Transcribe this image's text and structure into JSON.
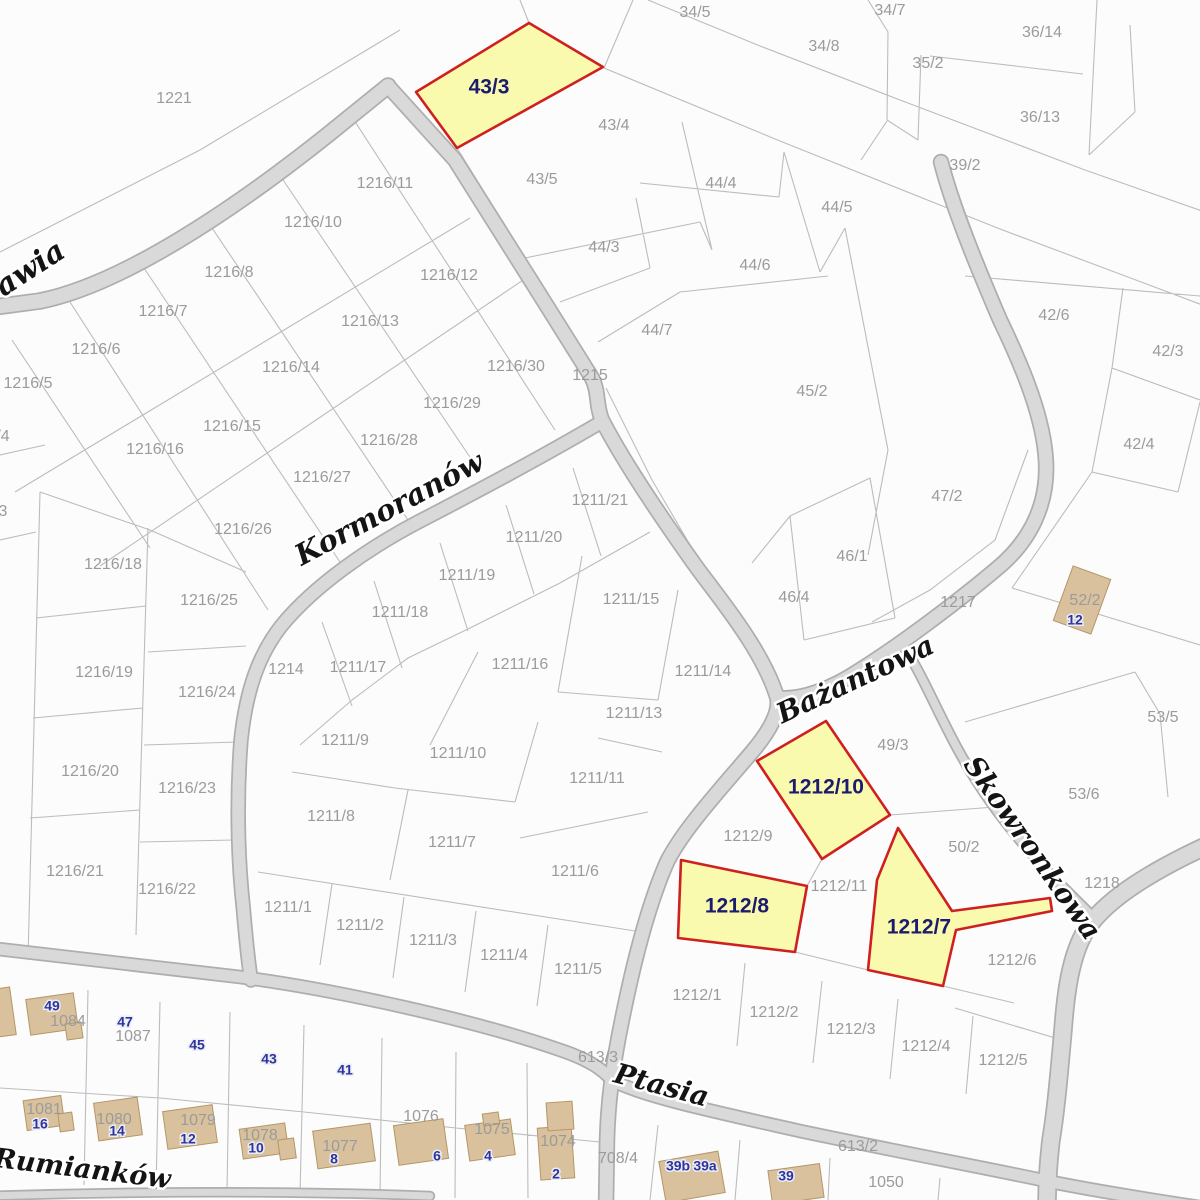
{
  "canvas": {
    "width": 1200,
    "height": 1200
  },
  "palette": {
    "bg": "#fcfcfc",
    "parcel_line": "#bcbcbc",
    "road_fill": "#d9d9d9",
    "road_edge": "#aeaeae",
    "highlight_fill": "#fafaaf",
    "highlight_border": "#cf2020",
    "building_fill": "#d8c19c",
    "building_edge": "#b49668",
    "label_gray": "#9b9b9b",
    "label_navy": "#1c1c6e",
    "badge_navy": "#32329b"
  },
  "streets": [
    {
      "name": "Żurawia",
      "x": 6,
      "y": 286,
      "rot": -33,
      "size": 30
    },
    {
      "name": "Kormoranów",
      "x": 390,
      "y": 510,
      "rot": -28,
      "size": 29
    },
    {
      "name": "Bażantowa",
      "x": 856,
      "y": 681,
      "rot": -25,
      "size": 28
    },
    {
      "name": "Skowronkowa",
      "x": 1031,
      "y": 849,
      "rot": 55,
      "size": 28
    },
    {
      "name": "Ptasia",
      "x": 661,
      "y": 1087,
      "rot": 15,
      "size": 28
    },
    {
      "name": "Rumianków",
      "x": 82,
      "y": 1170,
      "rot": 7,
      "size": 27
    }
  ],
  "highlight_parcels": [
    {
      "id": "43/3",
      "points": "416,92 529,23 603,67 457,148",
      "label": {
        "text": "43/3",
        "x": 489,
        "y": 88
      }
    },
    {
      "id": "1212/10",
      "points": "757,761 826,721 890,815 822,859",
      "label": {
        "text": "1212/10",
        "x": 826,
        "y": 788
      }
    },
    {
      "id": "1212/8",
      "points": "681,860 807,886 795,952 678,938",
      "label": {
        "text": "1212/8",
        "x": 737,
        "y": 907
      }
    },
    {
      "id": "1212/7",
      "points": "898,828 952,911 1050,898 1052,911 956,930 943,986 868,970 877,880",
      "label": {
        "text": "1212/7",
        "x": 919,
        "y": 928
      }
    }
  ],
  "parcel_labels": [
    {
      "text": "34/5",
      "x": 695,
      "y": 13
    },
    {
      "text": "34/7",
      "x": 890,
      "y": 11
    },
    {
      "text": "34/8",
      "x": 824,
      "y": 47
    },
    {
      "text": "35/2",
      "x": 928,
      "y": 64
    },
    {
      "text": "36/14",
      "x": 1042,
      "y": 33
    },
    {
      "text": "36/13",
      "x": 1040,
      "y": 118
    },
    {
      "text": "39/2",
      "x": 965,
      "y": 166
    },
    {
      "text": "1221",
      "x": 174,
      "y": 99
    },
    {
      "text": "43/4",
      "x": 614,
      "y": 126
    },
    {
      "text": "43/5",
      "x": 542,
      "y": 180
    },
    {
      "text": "44/4",
      "x": 721,
      "y": 184
    },
    {
      "text": "44/5",
      "x": 837,
      "y": 208
    },
    {
      "text": "44/3",
      "x": 604,
      "y": 248
    },
    {
      "text": "44/6",
      "x": 755,
      "y": 266
    },
    {
      "text": "44/7",
      "x": 657,
      "y": 331
    },
    {
      "text": "45/2",
      "x": 812,
      "y": 392
    },
    {
      "text": "42/6",
      "x": 1054,
      "y": 316
    },
    {
      "text": "42/3",
      "x": 1168,
      "y": 352
    },
    {
      "text": "42/4",
      "x": 1139,
      "y": 445
    },
    {
      "text": "47/2",
      "x": 947,
      "y": 497
    },
    {
      "text": "46/1",
      "x": 852,
      "y": 557
    },
    {
      "text": "46/4",
      "x": 794,
      "y": 598
    },
    {
      "text": "1217",
      "x": 958,
      "y": 603
    },
    {
      "text": "52/2",
      "x": 1085,
      "y": 601
    },
    {
      "text": "53/5",
      "x": 1163,
      "y": 718
    },
    {
      "text": "53/6",
      "x": 1084,
      "y": 795
    },
    {
      "text": "50/2",
      "x": 964,
      "y": 848
    },
    {
      "text": "1218",
      "x": 1102,
      "y": 884
    },
    {
      "text": "49/3",
      "x": 893,
      "y": 746
    },
    {
      "text": "1216/11",
      "x": 385,
      "y": 184
    },
    {
      "text": "1216/10",
      "x": 313,
      "y": 223
    },
    {
      "text": "1216/8",
      "x": 229,
      "y": 273
    },
    {
      "text": "1216/7",
      "x": 163,
      "y": 312
    },
    {
      "text": "1216/6",
      "x": 96,
      "y": 350
    },
    {
      "text": "1216/5",
      "x": 28,
      "y": 384
    },
    {
      "text": "/4",
      "x": 3,
      "y": 437
    },
    {
      "text": "3",
      "x": 3,
      "y": 512
    },
    {
      "text": "1216/12",
      "x": 449,
      "y": 276
    },
    {
      "text": "1216/13",
      "x": 370,
      "y": 322
    },
    {
      "text": "1216/14",
      "x": 291,
      "y": 368
    },
    {
      "text": "1216/15",
      "x": 232,
      "y": 427
    },
    {
      "text": "1216/16",
      "x": 155,
      "y": 450
    },
    {
      "text": "1216/30",
      "x": 516,
      "y": 367
    },
    {
      "text": "1215",
      "x": 590,
      "y": 376
    },
    {
      "text": "1216/29",
      "x": 452,
      "y": 404
    },
    {
      "text": "1216/28",
      "x": 389,
      "y": 441
    },
    {
      "text": "1216/27",
      "x": 322,
      "y": 478
    },
    {
      "text": "1216/26",
      "x": 243,
      "y": 530
    },
    {
      "text": "1216/25",
      "x": 209,
      "y": 601
    },
    {
      "text": "1216/18",
      "x": 113,
      "y": 565
    },
    {
      "text": "1216/19",
      "x": 104,
      "y": 673
    },
    {
      "text": "1216/24",
      "x": 207,
      "y": 693
    },
    {
      "text": "1214",
      "x": 286,
      "y": 670
    },
    {
      "text": "1216/20",
      "x": 90,
      "y": 772
    },
    {
      "text": "1216/23",
      "x": 187,
      "y": 789
    },
    {
      "text": "1216/21",
      "x": 75,
      "y": 872
    },
    {
      "text": "1216/22",
      "x": 167,
      "y": 890
    },
    {
      "text": "1211/21",
      "x": 600,
      "y": 501
    },
    {
      "text": "1211/20",
      "x": 534,
      "y": 538
    },
    {
      "text": "1211/19",
      "x": 467,
      "y": 576
    },
    {
      "text": "1211/18",
      "x": 400,
      "y": 613
    },
    {
      "text": "1211/17",
      "x": 358,
      "y": 668
    },
    {
      "text": "1211/16",
      "x": 520,
      "y": 665
    },
    {
      "text": "1211/15",
      "x": 631,
      "y": 600
    },
    {
      "text": "1211/14",
      "x": 703,
      "y": 672
    },
    {
      "text": "1211/13",
      "x": 634,
      "y": 714
    },
    {
      "text": "1211/11",
      "x": 597,
      "y": 779
    },
    {
      "text": "1211/10",
      "x": 458,
      "y": 754
    },
    {
      "text": "1211/9",
      "x": 345,
      "y": 741
    },
    {
      "text": "1211/8",
      "x": 331,
      "y": 817
    },
    {
      "text": "1211/7",
      "x": 452,
      "y": 843
    },
    {
      "text": "1211/6",
      "x": 575,
      "y": 872
    },
    {
      "text": "1211/5",
      "x": 578,
      "y": 970
    },
    {
      "text": "1211/4",
      "x": 504,
      "y": 956
    },
    {
      "text": "1211/3",
      "x": 433,
      "y": 941
    },
    {
      "text": "1211/2",
      "x": 360,
      "y": 926
    },
    {
      "text": "1211/1",
      "x": 288,
      "y": 908
    },
    {
      "text": "1212/9",
      "x": 748,
      "y": 837
    },
    {
      "text": "1212/11",
      "x": 839,
      "y": 887
    },
    {
      "text": "1212/6",
      "x": 1012,
      "y": 961
    },
    {
      "text": "1212/1",
      "x": 697,
      "y": 996
    },
    {
      "text": "1212/2",
      "x": 774,
      "y": 1013
    },
    {
      "text": "1212/3",
      "x": 851,
      "y": 1030
    },
    {
      "text": "1212/4",
      "x": 926,
      "y": 1047
    },
    {
      "text": "1212/5",
      "x": 1003,
      "y": 1061
    },
    {
      "text": "613/3",
      "x": 598,
      "y": 1058
    },
    {
      "text": "613/2",
      "x": 858,
      "y": 1147
    },
    {
      "text": "708/4",
      "x": 618,
      "y": 1159
    },
    {
      "text": "1050",
      "x": 886,
      "y": 1183
    },
    {
      "text": "1087",
      "x": 133,
      "y": 1037
    },
    {
      "text": "1084",
      "x": 68,
      "y": 1022
    },
    {
      "text": "1081",
      "x": 44,
      "y": 1110
    },
    {
      "text": "1080",
      "x": 114,
      "y": 1120
    },
    {
      "text": "1079",
      "x": 198,
      "y": 1121
    },
    {
      "text": "1078",
      "x": 260,
      "y": 1136
    },
    {
      "text": "1077",
      "x": 340,
      "y": 1147
    },
    {
      "text": "1076",
      "x": 421,
      "y": 1117
    },
    {
      "text": "1075",
      "x": 492,
      "y": 1130
    },
    {
      "text": "1074",
      "x": 558,
      "y": 1142
    }
  ],
  "address_badges": [
    {
      "text": "49",
      "x": 52,
      "y": 1007
    },
    {
      "text": "47",
      "x": 125,
      "y": 1023
    },
    {
      "text": "45",
      "x": 197,
      "y": 1046
    },
    {
      "text": "43",
      "x": 269,
      "y": 1060
    },
    {
      "text": "41",
      "x": 345,
      "y": 1071
    },
    {
      "text": "16",
      "x": 40,
      "y": 1125
    },
    {
      "text": "14",
      "x": 117,
      "y": 1132
    },
    {
      "text": "12",
      "x": 188,
      "y": 1140
    },
    {
      "text": "10",
      "x": 256,
      "y": 1149
    },
    {
      "text": "8",
      "x": 334,
      "y": 1160
    },
    {
      "text": "6",
      "x": 437,
      "y": 1157
    },
    {
      "text": "4",
      "x": 488,
      "y": 1157
    },
    {
      "text": "2",
      "x": 556,
      "y": 1175
    },
    {
      "text": "39b",
      "x": 678,
      "y": 1167
    },
    {
      "text": "39a",
      "x": 705,
      "y": 1167
    },
    {
      "text": "39",
      "x": 786,
      "y": 1177
    },
    {
      "text": "12",
      "x": 1075,
      "y": 621
    }
  ],
  "buildings": [
    [
      1082,
      600,
      40,
      58,
      20
    ],
    [
      4,
      1012,
      18,
      48,
      -8
    ],
    [
      52,
      1014,
      48,
      36,
      -8
    ],
    [
      74,
      1031,
      16,
      16,
      -8
    ],
    [
      44,
      1113,
      38,
      30,
      -8
    ],
    [
      66,
      1122,
      14,
      18,
      -8
    ],
    [
      118,
      1119,
      44,
      38,
      -8
    ],
    [
      190,
      1127,
      50,
      38,
      -8
    ],
    [
      264,
      1141,
      46,
      30,
      -8
    ],
    [
      287,
      1149,
      16,
      20,
      -8
    ],
    [
      344,
      1146,
      58,
      38,
      -8
    ],
    [
      421,
      1142,
      50,
      40,
      -8
    ],
    [
      490,
      1140,
      46,
      36,
      -8
    ],
    [
      491,
      1119,
      16,
      12,
      -8
    ],
    [
      556,
      1153,
      34,
      52,
      -4
    ],
    [
      560,
      1116,
      26,
      28,
      -4
    ],
    [
      692,
      1177,
      60,
      42,
      -10
    ],
    [
      796,
      1184,
      52,
      34,
      -8
    ]
  ],
  "roads": [
    {
      "name": "zurawia",
      "w": 14,
      "d": "M-20,309 L40,301 C120,285 230,213 330,133 L388,86"
    },
    {
      "name": "glowna-1215",
      "w": 13,
      "d": "M388,86 L455,160 L540,295 L592,378 C599,392 596,406 602,420 C625,465 668,527 695,565 C715,593 762,648 777,697 C781,712 768,733 752,752 C718,792 683,830 667,862 C649,903 634,960 622,1020 C613,1063 608,1100 607,1140 L606,1205"
    },
    {
      "name": "kormoranow",
      "w": 12,
      "d": "M598,424 C540,458 480,490 420,521 C370,547 315,585 282,625 C258,655 246,692 241,740 C237,790 237,850 243,905 C246,940 248,960 251,980"
    },
    {
      "name": "bazantowa-luk",
      "w": 13,
      "d": "M941,162 C952,205 975,262 1000,320 C1025,372 1044,420 1046,462 C1048,505 1030,540 1000,566 C960,600 900,645 860,670 C830,690 800,700 779,698"
    },
    {
      "name": "skowronkowa-wschod",
      "w": 16,
      "d": "M1206,846 C1150,872 1105,900 1086,930 C1071,955 1066,990 1063,1030 C1059,1075 1056,1110 1051,1140 C1048,1165 1047,1185 1047,1206"
    },
    {
      "name": "skowronkowa",
      "w": 8,
      "d": "M905,648 C925,680 941,720 961,755 C986,800 1021,845 1061,885 L1092,916"
    },
    {
      "name": "ptasia",
      "w": 11,
      "d": "M-10,948 C80,958 160,968 240,977 C340,990 480,1022 560,1050 C590,1060 603,1070 612,1080 C640,1096 720,1113 800,1131 C880,1148 980,1167 1047,1181 C1090,1190 1140,1198 1206,1208"
    },
    {
      "name": "rumiankow-pas",
      "w": 7,
      "d": "M-10,1196 C140,1191 300,1191 430,1196"
    }
  ],
  "boundaries": [
    "M648,0 L760,46 L900,100 L1085,170 L1205,212",
    "M604,68 L780,141 L1000,229 L1205,306",
    "M633,0 L604,68",
    "M868,0 L888,32 L887,120",
    "M921,55 L918,140",
    "M930,56 L1083,74",
    "M1097,0 L1089,155",
    "M1130,25 L1135,112",
    "M1089,155 L1135,112",
    "M918,140 L887,120",
    "M0,252 L200,150 L400,30",
    "M529,23 L520,0",
    "M861,160 L887,121",
    "M457,148 L525,258",
    "M682,122 L712,250",
    "M525,258 L700,222",
    "M700,222 L712,250",
    "M640,183 L779,197",
    "M779,197 L784,152",
    "M784,152 L820,272",
    "M680,292 L828,276",
    "M820,272 L845,228",
    "M845,228 L888,450",
    "M888,450 L868,555",
    "M598,342 L680,292",
    "M636,198 L650,268",
    "M560,302 L650,268",
    "M606,388 L652,480 L700,562",
    "M790,516 L870,478",
    "M790,516 L804,640",
    "M870,478 L895,618",
    "M804,640 L895,618",
    "M752,563 L790,516",
    "M1028,450 L995,540 L930,590 L872,622",
    "M965,276 L1200,296",
    "M1123,288 L1112,368",
    "M1112,368 L1200,400",
    "M1112,368 L1092,472",
    "M1092,472 L1178,492",
    "M1178,492 L1200,402",
    "M1092,472 L1012,588",
    "M1012,588 L1200,645",
    "M965,722 L1135,672",
    "M1135,672 L1160,714",
    "M1160,714 L1168,797",
    "M890,815 L1008,806",
    "M822,859 L807,886",
    "M795,952 L868,970",
    "M943,986 L1014,1003",
    "M745,963 L737,1046",
    "M822,981 L813,1063",
    "M898,999 L890,1079",
    "M973,1016 L966,1094",
    "M955,1008 L1062,1040",
    "M573,468 L601,556",
    "M506,505 L534,594",
    "M440,543 L468,631",
    "M374,581 L402,668",
    "M322,622 L352,706",
    "M650,532 L560,583 L470,628 L408,658 L352,700 L300,745",
    "M582,556 L558,692",
    "M678,590 L658,700",
    "M558,692 L658,700",
    "M478,652 L430,745",
    "M598,738 L662,752",
    "M538,722 L515,802",
    "M648,812 L520,838",
    "M515,802 L395,788",
    "M395,788 L292,772",
    "M408,790 L390,880",
    "M258,872 L648,933",
    "M332,884 L320,965",
    "M404,897 L393,978",
    "M476,911 L465,992",
    "M548,925 L537,1006",
    "M352,117 L555,430",
    "M275,168 L480,472",
    "M204,216 L408,520",
    "M138,259 L340,562",
    "M70,302 L268,610",
    "M12,340 L150,548",
    "M470,218 L15,492",
    "M535,272 L100,566",
    "M0,455 L45,445",
    "M0,540 L36,532",
    "M148,528 L136,935",
    "M40,492 L28,958",
    "M36,618 L146,606",
    "M33,718 L143,708",
    "M30,818 L140,810",
    "M148,652 L246,646",
    "M144,745 L238,742",
    "M140,842 L234,840",
    "M40,492 L150,530",
    "M150,530 L246,572",
    "M88,990 L84,1185",
    "M160,1002 L156,1190",
    "M230,1012 L227,1192",
    "M304,1025 L300,1195",
    "M382,1038 L380,1196",
    "M456,1052 L455,1198",
    "M527,1063 L528,1198",
    "M0,1088 L160,1098 L304,1112 L456,1128 L600,1142",
    "M658,1125 L650,1200",
    "M740,1140 L735,1200",
    "M830,1158 L828,1200",
    "M940,1178 L938,1200"
  ]
}
